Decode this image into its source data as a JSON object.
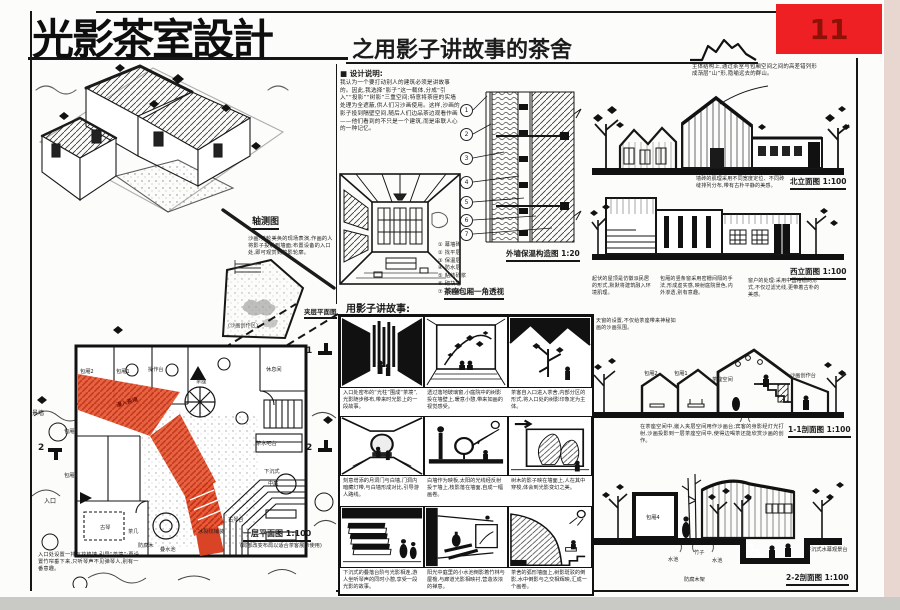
{
  "badge": {
    "number": "11"
  },
  "title": {
    "main": "光影茶室設計",
    "subtitle": "之用影子讲故事的茶舍"
  },
  "design_notes": {
    "heading": "■ 设计说明:",
    "body": "我认为一个要打动别人的建筑必须是讲故事的。因此,我选择“影子”这一载体,分成“引入”“投影”“树影”三重空间;特意将茶座的实墙处理为全遮蔽,供人们习沙画使用。这样,沙画的影子投到隔壁空间,随后人们边品茶边观看作画——他们看到的不只是一个建筑,而是串联人心的一种记忆。"
  },
  "axon": {
    "label": "轴测图",
    "note": "沙画:美轮美奂的现场表演,作画的人将影子投射到墙面;布置设备的入口处,即可观赏到剪影轮廓。",
    "mezzanine_label": "夹层平面图",
    "mezzanine_room": "(沙画创作区)"
  },
  "plan": {
    "title": "一层平面图 1:100",
    "title_note": "(局部改变布局以适合茶客展示使用)",
    "corridor_label": "漫入茶境",
    "rooms": [
      "包厢2",
      "包厢1",
      "操作台",
      "茶座",
      "休息间",
      "包厢3",
      "包厢4",
      "茶水吧台",
      "下沉式",
      "中庭",
      "古琴台"
    ],
    "marks": [
      "1",
      "2"
    ],
    "side_labels": [
      "景墙",
      "入口"
    ],
    "bottom_labels": [
      "古琴",
      "茶几",
      "防腐木",
      "叠水池",
      "冰裂纹铺装"
    ],
    "entry_note": "入口处设置一排瓦花格墙,引导“茶境”;再设置竹帘垂下来,只听琴声不见弹琴人,别有一番意趣。"
  },
  "perspective": {
    "label": "茶座包厢一角透视"
  },
  "detail": {
    "label": "外墙保温构造图 1:20",
    "callouts": [
      "1",
      "2",
      "3",
      "4",
      "5",
      "6",
      "7"
    ],
    "legend": [
      "① 幕墙砖",
      "② 找平层",
      "③ 保温层",
      "④ 防水层",
      "⑤ 粘结砂浆",
      "⑥ 砌块墙",
      "⑦ 内饰面"
    ]
  },
  "story": {
    "heading": "用影子讲故事:",
    "panels": [
      {
        "caption": "入口处密布的“光柱”围成“茶境”,光影随步移布,带来时光影上的一段故事。"
      },
      {
        "caption": "透过落地玻璃窗,小庭院中的树影投在墙壁上,暖意小憩,带来如画的视觉感受。"
      },
      {
        "caption": "茶客自入口进入茶舍,内部分区的形式,将入口处的树影印象定为主体。"
      },
      {
        "caption": "刻意增添的月洞门与白墙,门洞内暗藏灯带,与白墙形成对比,引导游人路线。"
      },
      {
        "caption": "白墙作为映板,太阳的光线经反射投于墙上,枝影落在墙面,自成一幅画卷。"
      },
      {
        "caption": "树木的影子映在墙面上,人在其中穿梭,体会到光影变幻之美。"
      },
      {
        "caption": "下沉式的叠落台阶与光影相连,游人坐听琴声的同时小憩,享受一段光影的故事。"
      },
      {
        "caption": "阳光中庭里的小水池倒影着竹林与屋檐,与廊道光影相映衬,营造浓浓的禅意。"
      },
      {
        "caption": "茶舍的弧形墙面上,树影斑驳的倒影,水中倒影与之交相辉映,汇成一个画卷。"
      }
    ]
  },
  "north_elevation": {
    "label": "北立面图 1:100",
    "note_top": "主体结构上,通过茶室与包厢空间之间的高差错列形成渐层“山”形,隐喻远去的群山。",
    "note_bottom": "墙砖的肌理采用不同宽度定位、不同砖缝排列分布,带有古朴平静的美感。"
  },
  "west_elevation": {
    "label": "西立面图 1:100",
    "notes": [
      "起伏的屋顶是仿徽派民居的形式,默默将建筑融入环境肌理。",
      "包厢的竖条窗采用密栅间隔的手法,形成虚实感,映射庭院景色,内外渗透,别有意趣。",
      "窗户的处理:采用中国格栅的形式,不仅过滤光线,更带着古朴的美感。"
    ]
  },
  "section_11": {
    "label": "1-1剖面图 1:100",
    "rooms": [
      "包厢2",
      "包厢1",
      "茶座空间",
      "沙画创作台"
    ],
    "note_top": "天窗的设置,不仅给茶座带来神秘如画的沙画氛围。",
    "note_bottom": "在茶座空间中,嵌入夹层空间用作沙画台;宾客的身影经灯光打射,沙画投影到一层茶座空间中,使得边喝茶还能欣赏沙画的创作。"
  },
  "section_22": {
    "label": "2-2剖面图 1:100",
    "labels": [
      "包厢4",
      "水池",
      "竹子",
      "水池",
      "防腐木架",
      "下沉式水幕观景台"
    ]
  },
  "colors": {
    "ink": "#1c1c1c",
    "badge_bg": "#ee2024",
    "badge_text": "#8c1106",
    "plan_red": "#e85a35"
  }
}
